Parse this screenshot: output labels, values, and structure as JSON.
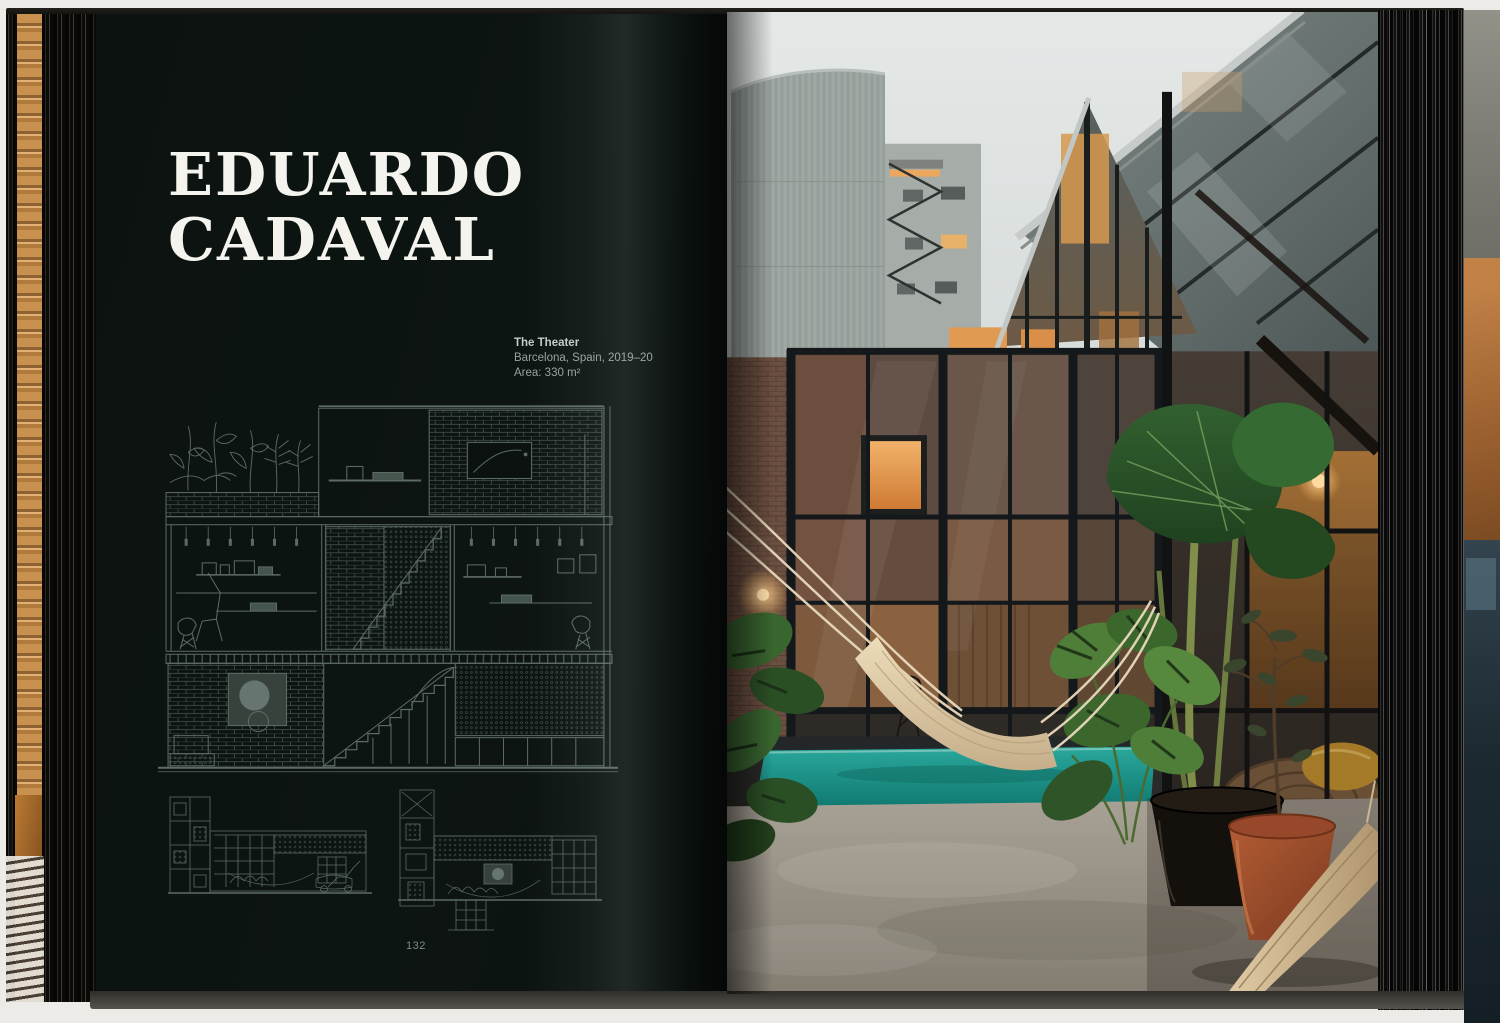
{
  "book": {
    "left_page": {
      "title": {
        "line1": "EDUARDO",
        "line2": "CADAVAL"
      },
      "caption": {
        "project": "The Theater",
        "location": "Barcelona, Spain, 2019–20",
        "area": "Area: 330 m²"
      },
      "page_number": "132",
      "drawings": {
        "main": "building cross-section: roof garden, two studio floors, stair, brick and lattice walls",
        "small_left": "longitudinal site section with street tower",
        "small_right": "longitudinal site section with courtyard and basement"
      }
    },
    "right_page": {
      "photo_alt": "Dusk courtyard: black steel-and-glass facade with warm lit interior, white hammock, turquoise plunge pool, concrete floor, monstera plants, black and terracotta pots"
    },
    "colors": {
      "left_page_bg": "#0c1311",
      "title_text": "#f4f3ee",
      "caption_text": "#97a29c",
      "drawing_line": "#5d6b66",
      "sky": "#e0e5e4",
      "pool_teal": "#1f9a90",
      "hammock_cream": "#e6d5b6",
      "terracotta": "#a4512d",
      "warm_glow": "#e8a159"
    }
  }
}
